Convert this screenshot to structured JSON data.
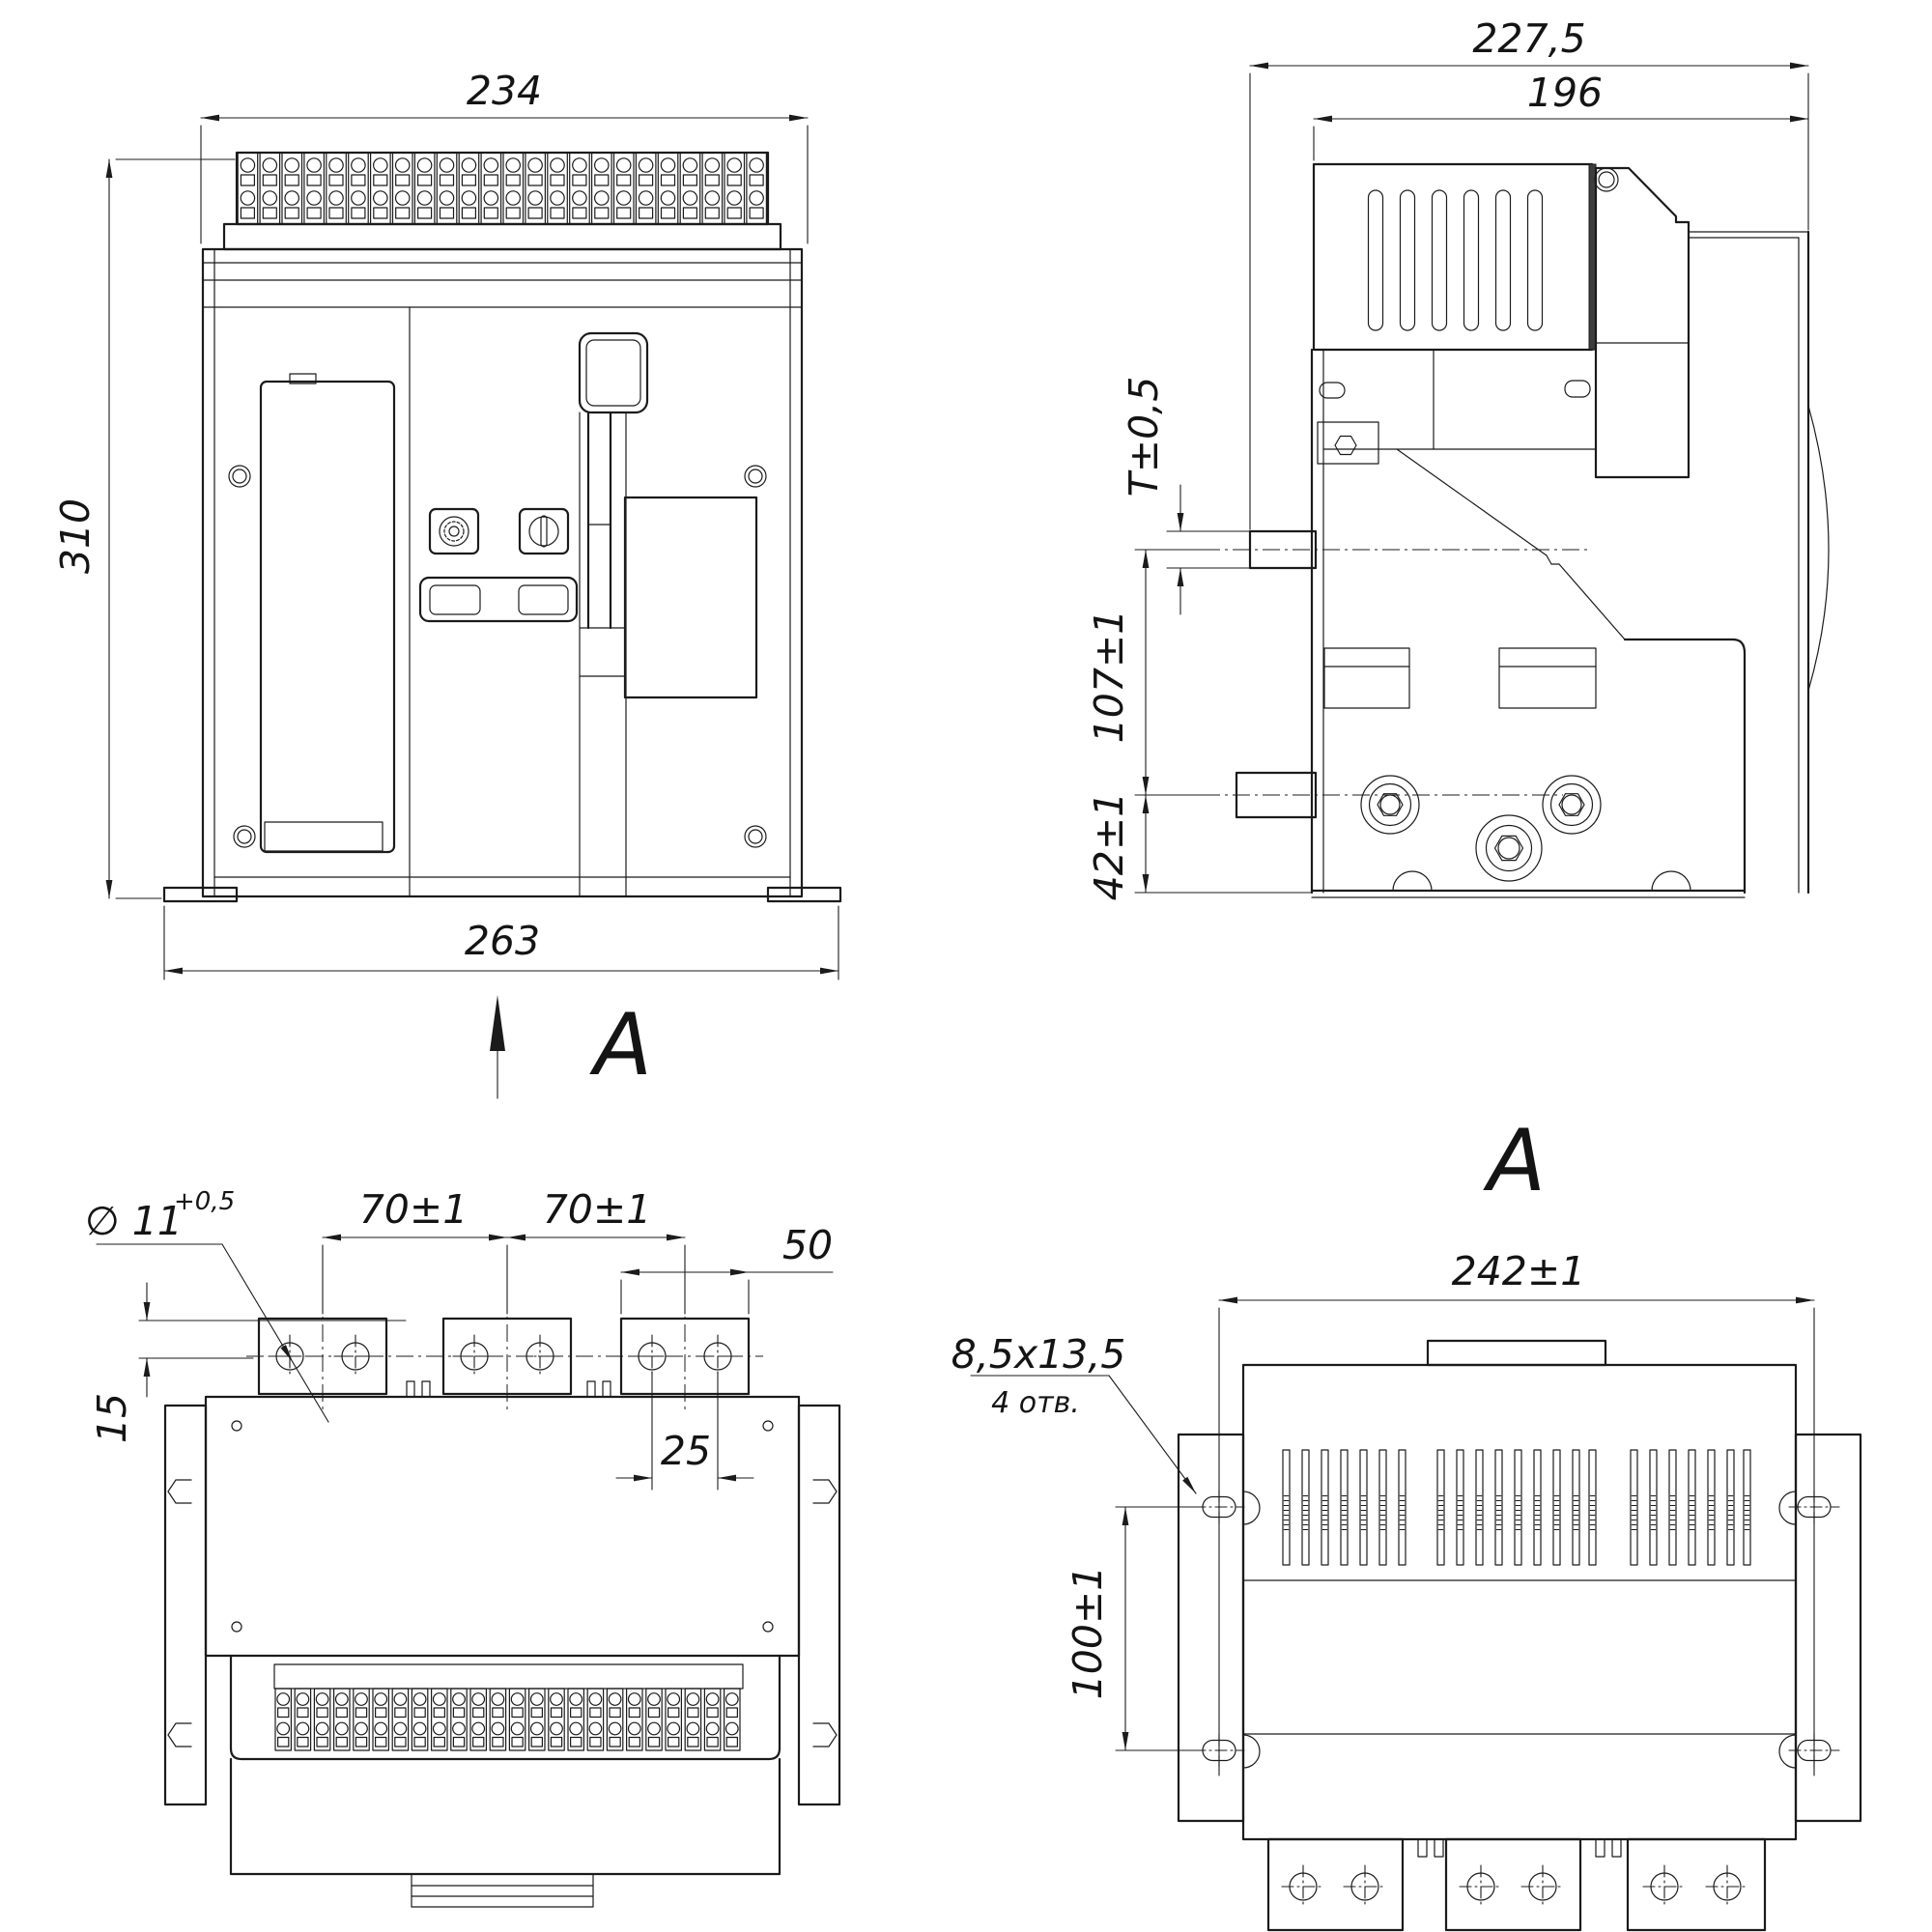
{
  "drawing": {
    "kind": "engineering dimensional drawing, air circuit breaker, 4 projection views",
    "background": "#ffffff",
    "line_color": "#1b1b1b",
    "views": {
      "front": {
        "label": "front view",
        "dim_width_top": "234",
        "dim_height": "310",
        "dim_width_bottom": "263",
        "view_arrow_letter": "A"
      },
      "side": {
        "label": "side view",
        "dim_depth_total": "227,5",
        "dim_depth_body": "196",
        "dim_terminal_thickness": "T±0,5",
        "dim_terminal_pitch": "107±1",
        "dim_lower_terminal_height": "42±1"
      },
      "top": {
        "label": "top view",
        "dim_hole_diameter": "∅ 11",
        "dim_hole_diameter_tol": "+0,5",
        "dim_pole_pitch_left": "70±1",
        "dim_pole_pitch_right": "70±1",
        "dim_pad_width": "50",
        "dim_hole_pitch": "25",
        "dim_hole_offset": "15"
      },
      "rear": {
        "title_letter": "A",
        "dim_mounting_width": "242±1",
        "dim_mounting_hole_size": "8,5x13,5",
        "dim_mounting_hole_count": "4 отв.",
        "dim_mounting_height": "100±1"
      }
    }
  }
}
